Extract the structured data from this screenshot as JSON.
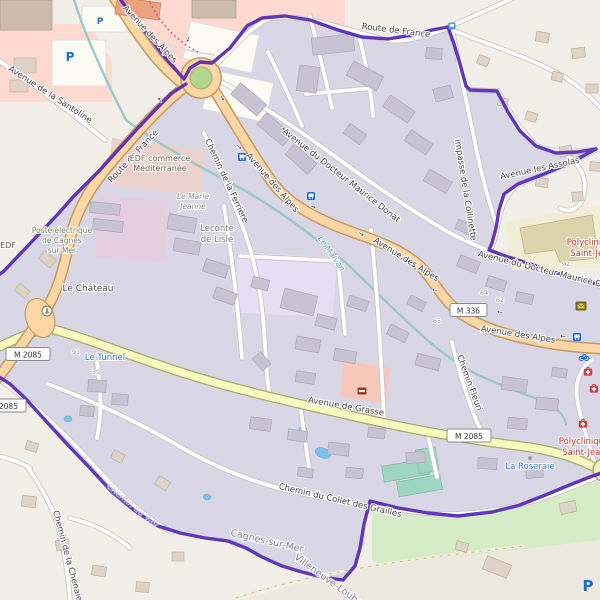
{
  "map_style": "openstreetmap carto with highlighted commune boundary",
  "colors": {
    "base": "#f2efe9",
    "district_tint": "#d9d7e5",
    "boundary": "#5a2db5",
    "primary_road": "#fcd6a4",
    "primary_casing": "#c69a60",
    "secondary_road": "#f7fabf",
    "secondary_casing": "#aaa86a",
    "minor_road": "#ffffff",
    "minor_casing": "#c9c9c9",
    "water": "#9cc8c8",
    "green": "#cdebb0",
    "pitch": "#9fd6c2",
    "retail": "#fed9cf",
    "hospital_grounds": "#f2eed6",
    "building": "#c8c3d3",
    "building_outside": "#ddd3c6",
    "poi_blue": "#3a74c4",
    "poi_red": "#b73225",
    "label_dark": "#454545",
    "admin_label": "#837a8e",
    "icon_blue": "#2268c9",
    "icon_red": "#d43d3d"
  },
  "roads": {
    "avenue_des_alpes": "Avenue des Alpes",
    "route_de_france": "Route de France",
    "avenue_du_docteur": "Avenue du Docteur Maurice Donat",
    "impasse_collinette": "Impasse de la Collinette",
    "avenue_assolas": "Avenue les Assolas",
    "chemin_ferriere": "Chemin de la Ferrière",
    "avenue_santoline": "Avenue de la Santoline",
    "avenue_grasse": "Avenue de Grasse",
    "chemin_fleuri": "Chemin Fleuri",
    "chemin_collet": "Chemin du Collet des Grailles",
    "chemin_chenaie": "Chemin de la Chenaie",
    "chemin_vay": "Chemin du Vay",
    "ref_m2085": "M 2085",
    "ref_m336": "M 336"
  },
  "places": {
    "cagnes": "Cagnes-sur-Mer",
    "villeneuve": "Villeneuve-Loubet",
    "edf_commerce_1": "EDF commerce",
    "edf_commerce_2": "Méditerranée",
    "poste_1": "Poste électrique",
    "poste_2": "de Cagnes",
    "poste_3": "sur Mer",
    "edf": "EDF",
    "marie_1": "Le Marie",
    "marie_2": "Jeanne",
    "leconte_1": "Leconte",
    "leconte_2": "de Lisle",
    "chateau": "Le Château",
    "tunnel": "Le Tunnel",
    "malvan": "Le Malvan",
    "roseraie": "La Roseraie",
    "polyclinique_1": "Polyclinique",
    "polyclinique_2": "Saint-Jean"
  },
  "house_numbers": {
    "n92": "92",
    "n64": "64",
    "n62": "62",
    "n65": "65",
    "n91": "91",
    "n39": "39"
  },
  "icons": {
    "parking_letter": "P",
    "names": [
      "parking-icon",
      "bus-stop-icon",
      "bicycle-parking-icon",
      "post-box-icon",
      "doctor-icon",
      "monument-icon",
      "fire-station-icon",
      "garden-icon",
      "oneway-arrow-icon"
    ]
  }
}
